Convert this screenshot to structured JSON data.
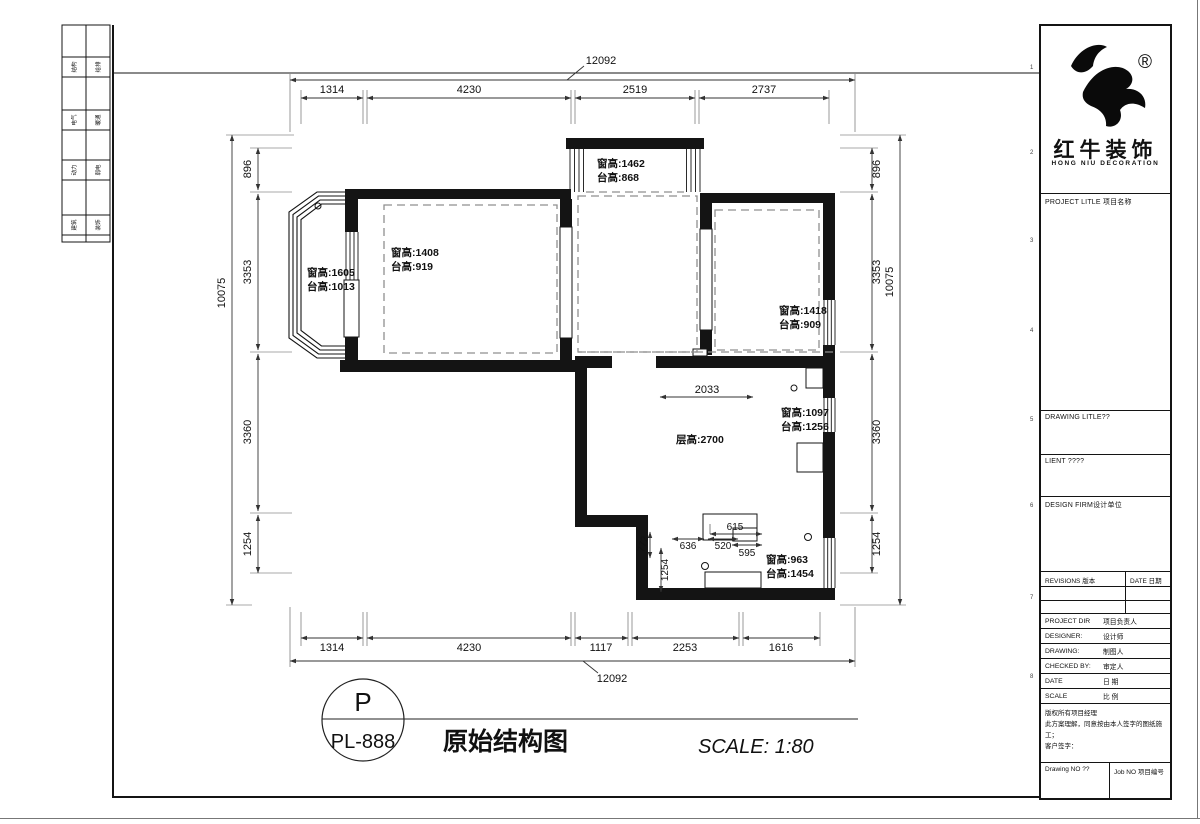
{
  "side_strip": {
    "rows": [
      [
        "结构",
        "给排"
      ],
      [
        "电气",
        "暖通"
      ],
      [
        "动力",
        "弱电"
      ],
      [
        "建筑",
        "装饰"
      ]
    ]
  },
  "frame_ticks": [
    "1",
    "2",
    "3",
    "4",
    "5",
    "6",
    "7",
    "8"
  ],
  "plan": {
    "overall_top": "12092",
    "overall_bottom": "12092",
    "overall_left": "10075",
    "overall_right": "10075",
    "top_segments": [
      "1314",
      "4230",
      "2519",
      "2737"
    ],
    "bottom_segments": [
      "1314",
      "4230",
      "1117",
      "2253",
      "1616"
    ],
    "left_segments": [
      "896",
      "3353",
      "3360",
      "1254"
    ],
    "right_segments": [
      "896",
      "3353",
      "3360",
      "1254"
    ],
    "inner_dims": {
      "span": "2033",
      "a": "615",
      "b": "636",
      "c": "520",
      "d": "595",
      "e": "772",
      "f": "1254"
    },
    "window_labels": {
      "top": {
        "l1": "窗高:1462",
        "l2": "台高:868"
      },
      "bay": {
        "l1": "窗高:1605",
        "l2": "台高:1013"
      },
      "left_room": {
        "l1": "窗高:1408",
        "l2": "台高:919"
      },
      "right_room": {
        "l1": "窗高:1418",
        "l2": "台高:909"
      },
      "living": {
        "l1": "窗高:1097",
        "l2": "台高:1256"
      },
      "bottom": {
        "l1": "窗高:963",
        "l2": "台高:1454"
      }
    },
    "ceiling_height": "层高:2700"
  },
  "title_note": {
    "bubble_letter": "P",
    "bubble_code": "PL-888",
    "drawing_title": "原始结构图",
    "scale_text": "SCALE: 1:80"
  },
  "title_block": {
    "brand": {
      "cn": "红牛装饰",
      "en": "HONG NIU DECORATION",
      "reg": "®"
    },
    "project_title_label": "PROJECT LITLE 项目名称",
    "drawing_title_label": "DRAWING LITLE??",
    "client_label": "LIENT ????",
    "design_firm_label": "DESIGN FIRM设计单位",
    "revisions_label": "REVISIONS 版本",
    "revisions_date_label": "DATE 日期",
    "credit_rows": [
      {
        "en": "PROJECT DIR",
        "cn": "项目负责人"
      },
      {
        "en": "DESIGNER:",
        "cn": "设计师"
      },
      {
        "en": "DRAWING:",
        "cn": "制图人"
      },
      {
        "en": "CHECKED BY:",
        "cn": "审定人"
      },
      {
        "en": "DATE",
        "cn": "日 期"
      },
      {
        "en": "SCALE",
        "cn": "比 例"
      }
    ],
    "notes": [
      "版权所有项目经理",
      "此方案理解，同意按由本人签字的图纸施工；",
      "客户签字："
    ],
    "drawing_no_label": "Drawing NO ??",
    "job_no_label": "Job NO 项目编号"
  }
}
